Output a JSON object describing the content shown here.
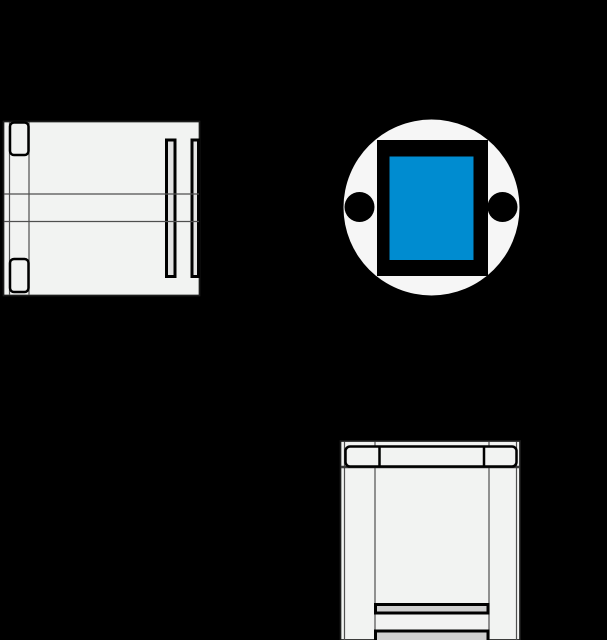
{
  "canvas": {
    "width": 607,
    "height": 640
  },
  "colors": {
    "background": "#000000",
    "part_fill": "#f2f3f2",
    "face_fill": "#f6f6f6",
    "slot_fill": "#e2e2e2",
    "bar_fill": "#cfcfcf",
    "accent_blue": "#008CD0",
    "solid_black": "#000000",
    "contour": "#1c1c1c",
    "edge": "#4f4f4f",
    "heavy_edge": "#3a3a3a"
  }
}
